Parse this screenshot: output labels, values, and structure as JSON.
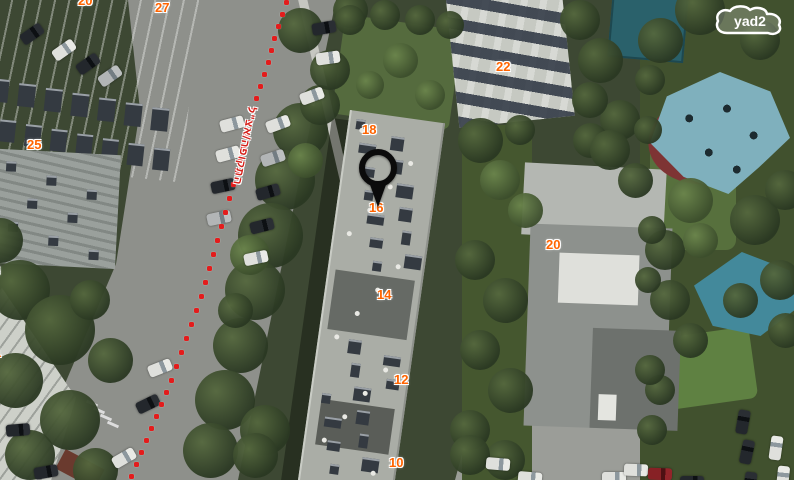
{
  "app": {
    "name": "yad2 map view"
  },
  "logo": {
    "text": "yad2"
  },
  "street_label": {
    "text": "התקופה/אצ\"ל",
    "color": "#d6201a"
  },
  "colors": {
    "building_number": "#ff6400",
    "boundary_dots": "#e31c1c",
    "pin": "#0b0b0b",
    "shade_sail": "#7fb0bd",
    "pool": "#2a616b"
  },
  "pin": {
    "x": 378,
    "y": 168,
    "meaning": "selected listing location"
  },
  "map_labels": [
    {
      "text": "20",
      "x": 78,
      "y": -7
    },
    {
      "text": "27",
      "x": 155,
      "y": 0
    },
    {
      "text": "25",
      "x": 27,
      "y": 137
    },
    {
      "text": "3",
      "x": -7,
      "y": 263
    },
    {
      "text": "1",
      "x": -6,
      "y": 345
    },
    {
      "text": "18",
      "x": 362,
      "y": 122
    },
    {
      "text": "16",
      "x": 369,
      "y": 200
    },
    {
      "text": "14",
      "x": 377,
      "y": 287
    },
    {
      "text": "12",
      "x": 394,
      "y": 372
    },
    {
      "text": "10",
      "x": 389,
      "y": 455
    },
    {
      "text": "22",
      "x": 496,
      "y": 59
    },
    {
      "text": "20",
      "x": 546,
      "y": 237
    }
  ],
  "boundary_points": [
    [
      286,
      2
    ],
    [
      282,
      14
    ],
    [
      278,
      26
    ],
    [
      274,
      38
    ],
    [
      271,
      50
    ],
    [
      268,
      62
    ],
    [
      264,
      74
    ],
    [
      260,
      86
    ],
    [
      256,
      98
    ],
    [
      252,
      110
    ],
    [
      249,
      122
    ],
    [
      246,
      134
    ],
    [
      243,
      146
    ],
    [
      240,
      158
    ],
    [
      237,
      170
    ],
    [
      233,
      184
    ],
    [
      229,
      198
    ],
    [
      225,
      212
    ],
    [
      221,
      226
    ],
    [
      217,
      240
    ],
    [
      213,
      254
    ],
    [
      209,
      268
    ],
    [
      205,
      282
    ],
    [
      201,
      296
    ],
    [
      196,
      310
    ],
    [
      191,
      324
    ],
    [
      186,
      338
    ],
    [
      181,
      352
    ],
    [
      176,
      366
    ],
    [
      171,
      380
    ],
    [
      166,
      392
    ],
    [
      161,
      404
    ],
    [
      156,
      416
    ],
    [
      151,
      428
    ],
    [
      146,
      440
    ],
    [
      141,
      452
    ],
    [
      136,
      464
    ],
    [
      131,
      476
    ]
  ]
}
